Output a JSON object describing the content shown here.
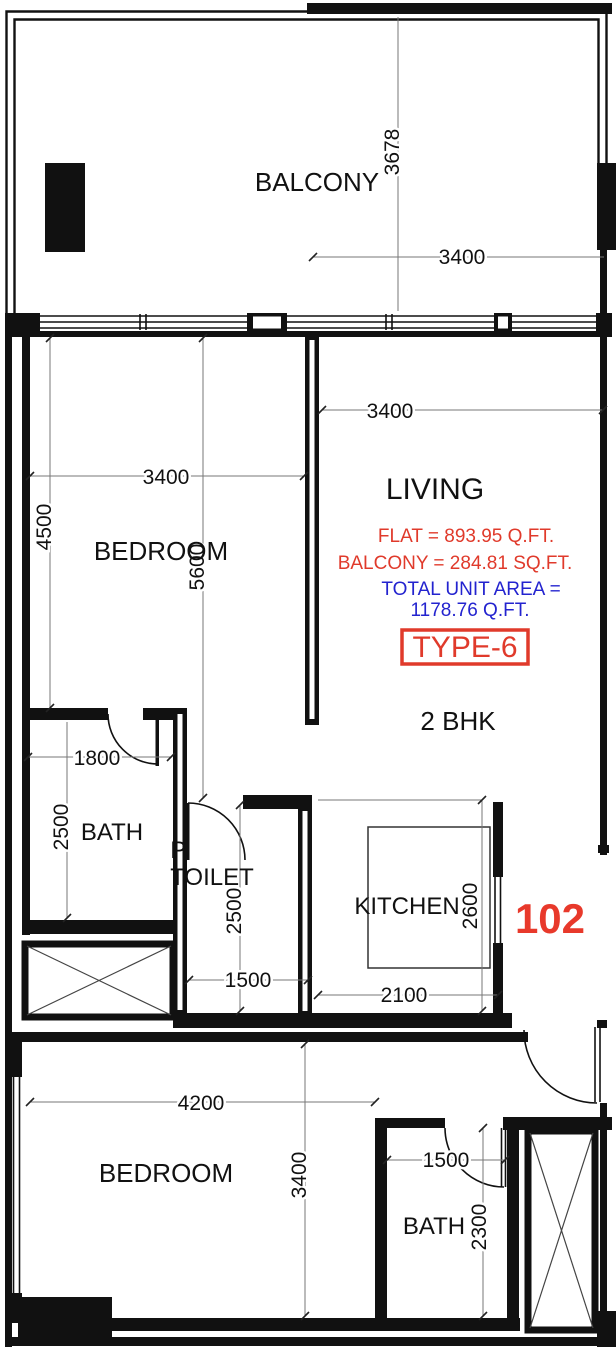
{
  "plan": {
    "unit_number": "102",
    "type_label": "TYPE-6",
    "bhk_label": "2 BHK",
    "area_info": {
      "flat": "FLAT  = 893.95  Q.FT.",
      "balcony": "BALCONY = 284.81 SQ.FT.",
      "total_line1": "TOTAL UNIT AREA =",
      "total_line2": "1178.76 Q.FT."
    },
    "rooms": {
      "balcony": "BALCONY",
      "living": "LIVING",
      "bedroom1": "BEDROOM",
      "bath1": "BATH",
      "ptoilet_line1": "P.",
      "ptoilet_line2": "TOILET",
      "kitchen": "KITCHEN",
      "bedroom2": "BEDROOM",
      "bath2": "BATH"
    },
    "dimensions": {
      "balcony_depth": "3678",
      "balcony_width": "3400",
      "living_width": "3400",
      "bedroom1_width": "3400",
      "bedroom1_height": "4500",
      "unit_depth": "5600",
      "bath1_width": "1800",
      "bath1_height": "2500",
      "toilet_height": "2500",
      "toilet_width": "1500",
      "kitchen_height": "2600",
      "kitchen_width": "2100",
      "bedroom2_width": "4200",
      "bedroom2_height": "3400",
      "bath2_width": "1500",
      "bath2_height": "2300"
    },
    "colors": {
      "wall": "#111111",
      "accent_red": "#e03a2b",
      "accent_blue": "#2323cf",
      "dim_line": "#777777"
    }
  }
}
